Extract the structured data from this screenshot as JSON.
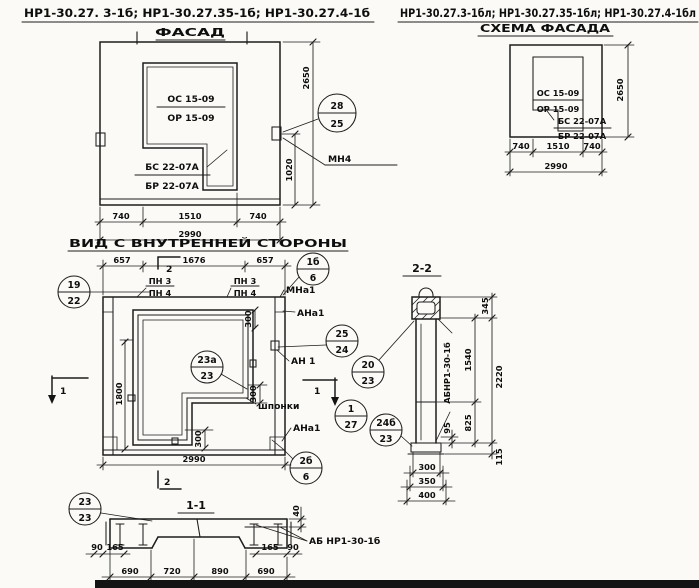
{
  "titles": {
    "left": "НР1-30.27. 3-1б;  НР1-30.27.35-1б;  НР1-30.27.4-1б",
    "right": "НР1-30.27.3-1бл; НР1-30.27.35-1бл; НР1-30.27.4-1бл"
  },
  "facade": {
    "title": "ФАСАД",
    "window_mark_top": "ОС 15-09",
    "window_mark_bottom": "ОР 15-09",
    "door_mark_top": "БС 22-07А",
    "door_mark_bottom": "БР 22-07А",
    "anchor_label": "МН4",
    "callout": {
      "top": "28",
      "bottom": "25"
    },
    "dims": {
      "height": "2650",
      "anchor_height": "1020",
      "left": "740",
      "middle": "1510",
      "right": "740",
      "total": "2990"
    }
  },
  "scheme": {
    "title": "СХЕМА ФАСАДА",
    "window_mark_top": "ОС 15-09",
    "window_mark_bottom": "ОР 15-09",
    "door_mark_top": "БС 22-07А",
    "door_mark_bottom": "БР 22-07А",
    "dims": {
      "height": "2650",
      "left": "740",
      "middle": "1510",
      "right": "740",
      "total": "2990"
    }
  },
  "inner": {
    "title": "ВИД С ВНУТРЕННЕЙ СТОРОНЫ",
    "dims": {
      "t1": "657",
      "t2": "1676",
      "t3": "657",
      "door": "1800",
      "s1": "300",
      "s2": "300",
      "s3": "300",
      "total": "2990"
    },
    "labels": {
      "pnl1": "ПН 3",
      "pnl2": "ПН 4",
      "pnr1": "ПН 3",
      "pnr2": "ПН 4",
      "mn": "МНа1",
      "ana_top": "АНа1",
      "an": "АН 1",
      "ana_bot": "АНа1",
      "shponki": "шпонки"
    },
    "callouts": {
      "c19": {
        "top": "19",
        "bottom": "22"
      },
      "c1b": {
        "top": "1б",
        "bottom": "6"
      },
      "c25": {
        "top": "25",
        "bottom": "24"
      },
      "c23a": {
        "top": "23а",
        "bottom": "23"
      },
      "c127": {
        "top": "1",
        "bottom": "27"
      },
      "c2b": {
        "top": "2б",
        "bottom": "6"
      }
    },
    "markers": {
      "m1": "1",
      "m2": "2"
    }
  },
  "sec11": {
    "title": "1-1",
    "beam_label": "АБ НР1-30-1б",
    "callout": {
      "top": "23",
      "bottom": "23"
    },
    "dims": {
      "top": "40",
      "l90": "90",
      "l165": "165",
      "r165": "165",
      "r90": "90",
      "b1": "690",
      "b2": "720",
      "b3": "890",
      "b4": "690"
    }
  },
  "sec22": {
    "title": "2-2",
    "beam_label": "АБНР1-30-1б",
    "c20": {
      "top": "20",
      "bottom": "23"
    },
    "c24": {
      "top": "24б",
      "bottom": "23"
    },
    "dims": {
      "d345": "345",
      "d1540": "1540",
      "d2220": "2220",
      "d825": "825",
      "d95": "95",
      "d115": "115",
      "w1": "300",
      "w2": "350",
      "w3": "400"
    }
  }
}
